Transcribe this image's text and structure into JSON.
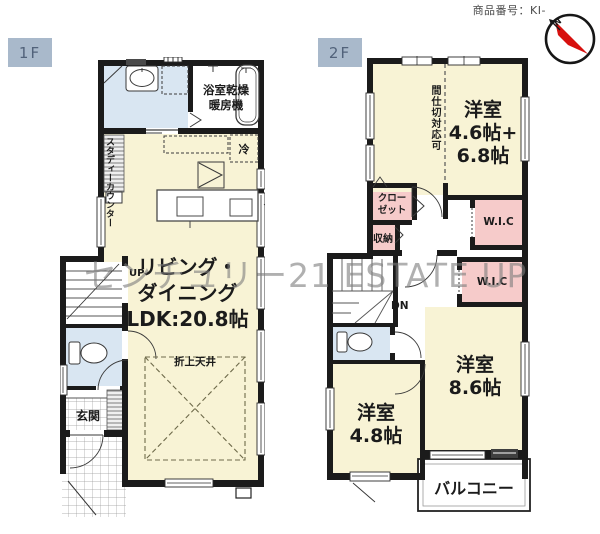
{
  "header": {
    "product_number": "商品番号：KI-",
    "compass_n": "N"
  },
  "watermark": "センチュリー21 ESTATE UP",
  "floor1": {
    "label": "1F",
    "bath_unit_line1": "浴室乾燥",
    "bath_unit_line2": "暖房機",
    "fridge": "冷",
    "study_counter_line1": "スタディー",
    "study_counter_line2": "カウンター",
    "stairs_up": "UP",
    "ldk_line1": "リビング・",
    "ldk_line2": "ダイニング",
    "ldk_line3": "LDK:20.8帖",
    "raised_ceiling": "折上天井",
    "entrance": "玄関"
  },
  "floor2": {
    "label": "2F",
    "partition_note": "間仕切対応可",
    "bedroom1_line1": "洋室",
    "bedroom1_line2": "4.6帖+",
    "bedroom1_line3": "6.8帖",
    "closet_line1": "クロー",
    "closet_line2": "ゼット",
    "storage": "収納",
    "wic_upper": "W.I.C",
    "wic_lower": "W.I.C",
    "stairs_down": "DN",
    "bedroom2_line1": "洋室",
    "bedroom2_line2": "8.6帖",
    "bedroom3_line1": "洋室",
    "bedroom3_line2": "4.8帖",
    "balcony": "バルコニー"
  },
  "colors": {
    "room_yellow": "#f8f3d5",
    "wet_blue": "#d9e6f2",
    "closet_pink": "#f6cbca",
    "wall_black": "#1b1b1b",
    "label_box_bg": "#a9b9cb",
    "compass_red": "#d7100e",
    "watermark_gray": "#7d7d7d"
  }
}
